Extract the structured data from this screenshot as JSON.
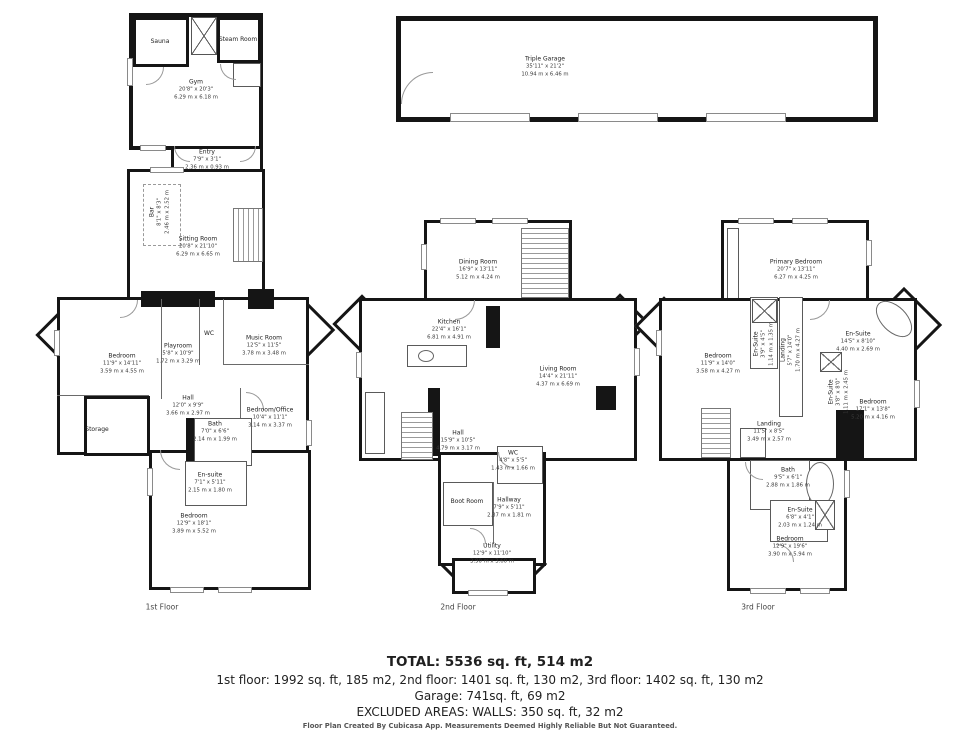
{
  "colors": {
    "wall": "#151515",
    "text": "#222222"
  },
  "summary": {
    "total": "TOTAL: 5536 sq. ft, 514 m2",
    "floors_line": "1st floor: 1992 sq. ft, 185 m2, 2nd floor: 1401 sq. ft, 130 m2, 3rd floor: 1402 sq. ft, 130 m2",
    "garage_line": "Garage: 741sq. ft,  69 m2",
    "excluded_line": "EXCLUDED AREAS: WALLS: 350 sq. ft, 32 m2",
    "disclaimer": "Floor Plan Created By Cubicasa App. Measurements Deemed Highly Reliable But Not Guaranteed."
  },
  "buildings": [
    {
      "id": "gym",
      "caption": null,
      "rooms": [
        {
          "label": "Sauna",
          "x": 160,
          "y": 42
        },
        {
          "label": "Steam Room",
          "x": 238,
          "y": 40
        },
        {
          "label": "Gym",
          "ft": "20'8\" x 20'3\"",
          "m": "6.29 m x 6.18 m",
          "x": 196,
          "y": 90
        },
        {
          "label": "Entry",
          "ft": "7'9\" x 3'1\"",
          "m": "2.36 m x 0.93 m",
          "x": 207,
          "y": 160
        }
      ]
    },
    {
      "id": "first",
      "caption": "1st Floor",
      "caption_x": 162,
      "caption_y": 607,
      "rooms": [
        {
          "label": "Bar",
          "ft": "8'1\" x 8'3\"",
          "m": "2.46 m x 2.52 m",
          "x": 160,
          "y": 212,
          "vertical": true
        },
        {
          "label": "Sitting Room",
          "ft": "20'8\" x 21'10\"",
          "m": "6.29 m x 6.65 m",
          "x": 198,
          "y": 247
        },
        {
          "label": "Bedroom",
          "ft": "11'9\" x 14'11\"",
          "m": "3.59 m x 4.55 m",
          "x": 122,
          "y": 364
        },
        {
          "label": "Playroom",
          "ft": "5'8\" x 10'9\"",
          "m": "1.72 m x 3.29 m",
          "x": 178,
          "y": 354
        },
        {
          "label": "WC",
          "x": 209,
          "y": 334
        },
        {
          "label": "Music Room",
          "ft": "12'5\" x 11'5\"",
          "m": "3.78 m x 3.48 m",
          "x": 264,
          "y": 346
        },
        {
          "label": "Hall",
          "ft": "12'0\" x 9'9\"",
          "m": "3.66 m x 2.97 m",
          "x": 188,
          "y": 406
        },
        {
          "label": "Storage",
          "x": 97,
          "y": 430
        },
        {
          "label": "Bath",
          "ft": "7'0\" x 6'6\"",
          "m": "2.14 m x 1.99 m",
          "x": 215,
          "y": 432
        },
        {
          "label": "Bedroom/Office",
          "ft": "10'4\" x 11'1\"",
          "m": "3.14 m x 3.37 m",
          "x": 270,
          "y": 418
        },
        {
          "label": "En-suite",
          "ft": "7'1\" x 5'11\"",
          "m": "2.15 m x 1.80 m",
          "x": 210,
          "y": 483
        },
        {
          "label": "Bedroom",
          "ft": "12'9\" x 18'1\"",
          "m": "3.89 m x 5.52 m",
          "x": 194,
          "y": 524
        }
      ]
    },
    {
      "id": "second",
      "caption": "2nd Floor",
      "caption_x": 458,
      "caption_y": 607,
      "rooms": [
        {
          "label": "Dining Room",
          "ft": "16'9\" x 13'11\"",
          "m": "5.12 m x 4.24 m",
          "x": 478,
          "y": 270
        },
        {
          "label": "Kitchen",
          "ft": "22'4\" x 16'1\"",
          "m": "6.81 m x 4.91 m",
          "x": 449,
          "y": 330
        },
        {
          "label": "Living Room",
          "ft": "14'4\" x 21'11\"",
          "m": "4.37 m x 6.69 m",
          "x": 558,
          "y": 377
        },
        {
          "label": "Hall",
          "ft": "15'9\" x 10'5\"",
          "m": "4.79 m x 3.17 m",
          "x": 458,
          "y": 441
        },
        {
          "label": "WC",
          "ft": "4'8\" x 5'5\"",
          "m": "1.43 m x 1.66 m",
          "x": 513,
          "y": 461
        },
        {
          "label": "Boot Room",
          "x": 467,
          "y": 502
        },
        {
          "label": "Hallway",
          "ft": "7'9\" x 5'11\"",
          "m": "2.37 m x 1.81 m",
          "x": 509,
          "y": 508
        },
        {
          "label": "Utility",
          "ft": "12'9\" x 11'10\"",
          "m": "3.90 m x 3.60 m",
          "x": 492,
          "y": 554
        }
      ]
    },
    {
      "id": "third",
      "caption": "3rd Floor",
      "caption_x": 758,
      "caption_y": 607,
      "rooms": [
        {
          "label": "Primary Bedroom",
          "ft": "20'7\" x 13'11\"",
          "m": "6.27 m x 4.25 m",
          "x": 796,
          "y": 270
        },
        {
          "label": "Bedroom",
          "ft": "11'9\" x 14'0\"",
          "m": "3.58 m x 4.27 m",
          "x": 718,
          "y": 364
        },
        {
          "label": "En-Suite",
          "ft": "3'9\" x 4'5\"",
          "m": "1.14 m x 1.35 m",
          "x": 764,
          "y": 344,
          "vertical": true
        },
        {
          "label": "Landing",
          "ft": "5'7\" x 14'0\"",
          "m": "1.70 m x 4.27 m",
          "x": 791,
          "y": 350,
          "vertical": true
        },
        {
          "label": "En-Suite",
          "ft": "14'5\" x 8'10\"",
          "m": "4.40 m x 2.69 m",
          "x": 858,
          "y": 342
        },
        {
          "label": "En-Suite",
          "ft": "3'8\" x 8'0\"",
          "m": "1.11 m x 2.45 m",
          "x": 839,
          "y": 392,
          "vertical": true
        },
        {
          "label": "Bedroom",
          "ft": "17'1\" x 13'8\"",
          "m": "5.20 m x 4.16 m",
          "x": 873,
          "y": 410
        },
        {
          "label": "Landing",
          "ft": "11'5\" x 8'5\"",
          "m": "3.49 m x 2.57 m",
          "x": 769,
          "y": 432
        },
        {
          "label": "Bath",
          "ft": "9'5\" x 6'1\"",
          "m": "2.88 m x 1.86 m",
          "x": 788,
          "y": 478
        },
        {
          "label": "En-Suite",
          "ft": "6'8\" x 4'1\"",
          "m": "2.03 m x 1.24 m",
          "x": 800,
          "y": 518
        },
        {
          "label": "Bedroom",
          "ft": "12'9\" x 19'6\"",
          "m": "3.90 m x 5.94 m",
          "x": 790,
          "y": 547
        }
      ]
    },
    {
      "id": "garage",
      "caption": null,
      "rooms": [
        {
          "label": "Triple Garage",
          "ft": "35'11\" x 21'2\"",
          "m": "10.94 m x 6.46 m",
          "x": 545,
          "y": 67
        }
      ]
    }
  ]
}
